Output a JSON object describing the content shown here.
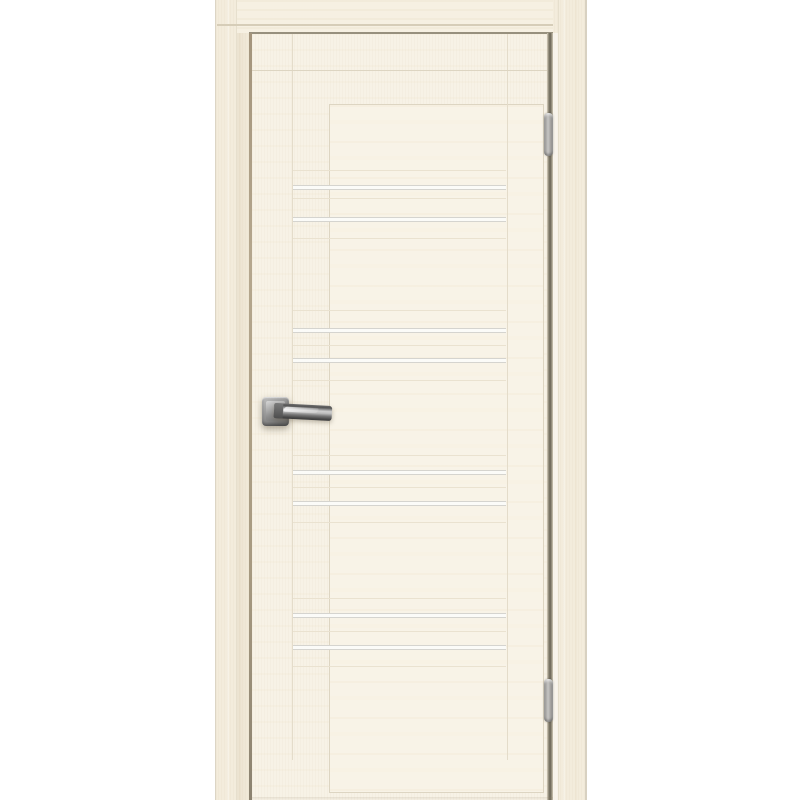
{
  "scene": {
    "type": "product-photo",
    "subject": "closed interior door with wooden frame, bleached-oak cream woodgrain finish, no visible text",
    "background_color": "#ffffff"
  },
  "door": {
    "finish_colors": {
      "wood": "#f7f2e6",
      "casing": "#f3ecdc",
      "header": "#f6f0e2",
      "panel": "#f8f3e7",
      "gap_dark": "#7c7666",
      "gap_light": "#ab9d84",
      "rebate_top": "#97907e",
      "joint_line": "#ddd5c2",
      "seam_line": "#eae2d0",
      "stripe_fill": "#fbfbf8",
      "stripe_border": "#d5d4cf",
      "hinge_metal": "#b4b3b1",
      "handle_metal": "#8f8f8f"
    },
    "glass_stripes": {
      "count": 8,
      "height_px": 5,
      "y_positions": [
        185,
        217,
        328,
        358,
        470,
        501,
        613,
        645
      ]
    },
    "seam_lines_y": [
      170,
      198,
      238,
      310,
      345,
      380,
      455,
      487,
      522,
      598,
      631,
      666
    ],
    "hinges": {
      "count": 2,
      "side": "right",
      "height_px": 43,
      "y_positions": [
        113,
        679
      ]
    },
    "handle": {
      "style": "square-rosette lever handle",
      "side": "left",
      "y_position": 397
    }
  }
}
